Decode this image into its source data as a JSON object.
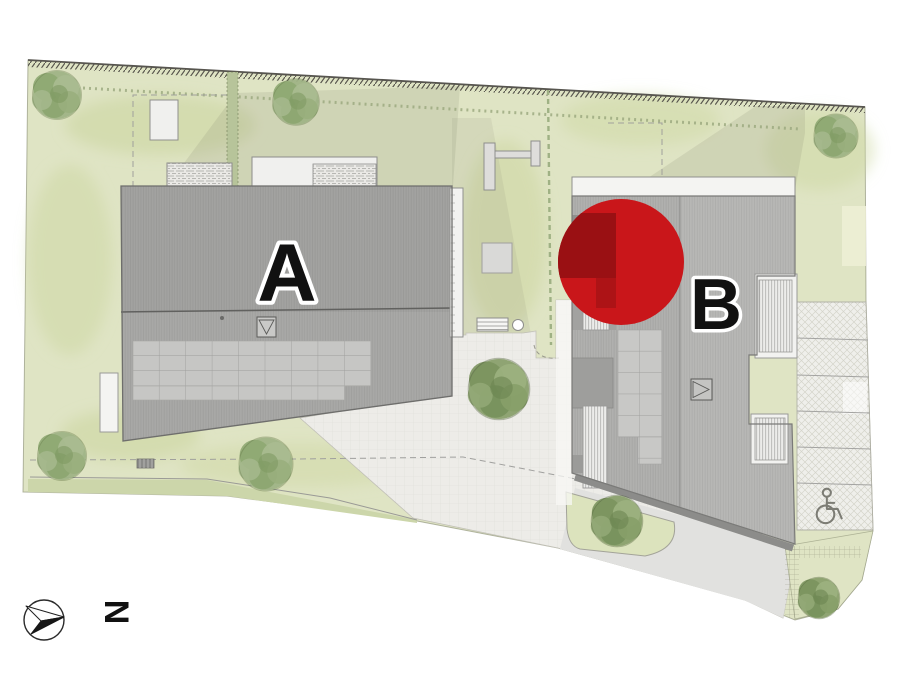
{
  "plan": {
    "type": "residential-site-plan",
    "buildings": [
      {
        "id": "A",
        "label": "A"
      },
      {
        "id": "B",
        "label": "B"
      }
    ],
    "marker": {
      "color": "#c9161a",
      "overlay_dark": "#9a1013",
      "overlay_mid": "#ad1316"
    },
    "compass": {
      "label": "N"
    },
    "icons": [
      {
        "name": "north-arrow-icon"
      },
      {
        "name": "wheelchair-icon"
      }
    ],
    "colors": {
      "background": "#ffffff",
      "lawn": "#dfe4c4",
      "lawn_verge": "#ccd6aa",
      "plaza": "#edece8",
      "sidewalk": "#e1e1df",
      "roof_a": "#a8a8a6",
      "roof_b": "#b0b0ae",
      "roof_b_light": "#b7b7b5",
      "solar_panel": "#c6c6c4",
      "white_terrace": "#f2f2f0",
      "parking": "#efefeb",
      "tree_light": "#9fb386",
      "tree_dark": "#8aa06d"
    }
  }
}
